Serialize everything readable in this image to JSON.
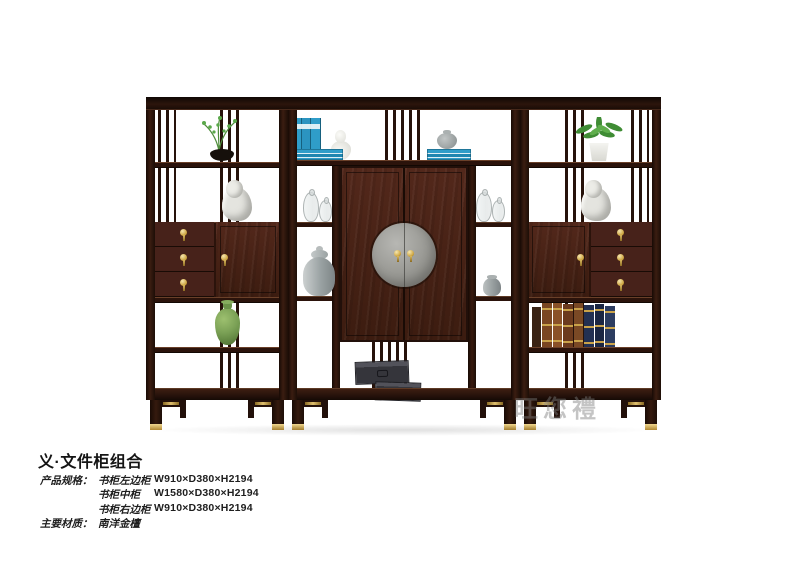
{
  "product": {
    "title": "义·文件柜组合",
    "specs_label": "产品规格：",
    "specs": [
      {
        "item": "书柜左边柜",
        "size": "W910×D380×H2194"
      },
      {
        "item": "书柜中柜",
        "size": "W1580×D380×H2194"
      },
      {
        "item": "书柜右边柜",
        "size": "W910×D380×H2194"
      }
    ],
    "material_label": "主要材质：",
    "material": "南洋金檀"
  },
  "watermark": {
    "text": "旺您禮"
  },
  "colors": {
    "background": "#ffffff",
    "wood_dark": "#1f0f08",
    "wood_mid": "#3a1b10",
    "wood_face": "#51261a",
    "brass": "#cfa84e",
    "medallion_gray": "#989894",
    "box_gray": "#38383d",
    "book_blue": "#2b9cc8",
    "plant_green": "#4f9040",
    "vase_green": "#7aa055",
    "porcelain_white": "#e8e8e4",
    "jar_gray": "#9aa0a2",
    "text_color": "#1e1e1e",
    "watermark_gray": "#8a8a8a"
  }
}
